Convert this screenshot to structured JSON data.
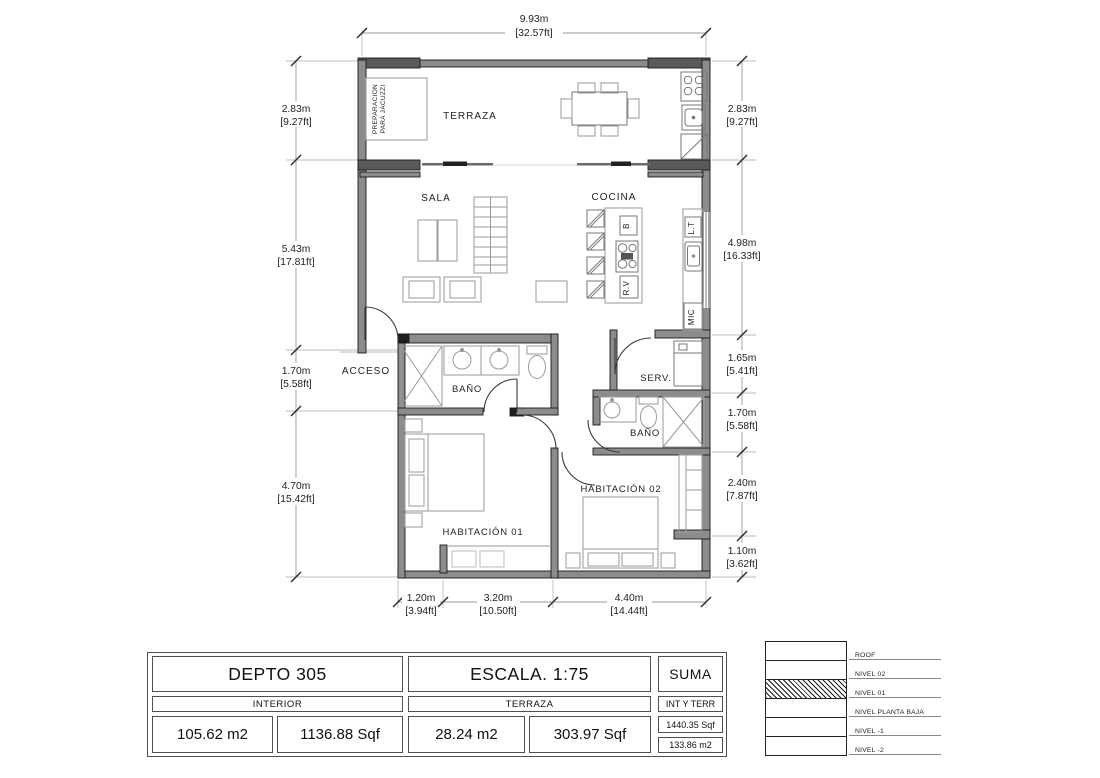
{
  "plan": {
    "rooms": {
      "terraza": "TERRAZA",
      "sala": "SALA",
      "cocina": "COCINA",
      "acceso": "ACCESO",
      "banio1": "BAÑO",
      "serv": "SERV.",
      "banio2": "BAÑO",
      "habitacion01": "HABITACIÓN 01",
      "habitacion02": "HABITACIÓN 02"
    },
    "notes": {
      "jacuzzi_line1": "PREPARACION",
      "jacuzzi_line2": "PARA JACUZZI"
    },
    "fixtures": {
      "b": "B",
      "rv": "R.V",
      "lt": "L.T",
      "mic": "MIC"
    },
    "dimensions": {
      "top": {
        "m": "9.93m",
        "ft": "[32.57ft]"
      },
      "left": [
        {
          "m": "2.83m",
          "ft": "[9.27ft]"
        },
        {
          "m": "5.43m",
          "ft": "[17.81ft]"
        },
        {
          "m": "1.70m",
          "ft": "[5.58ft]"
        },
        {
          "m": "4.70m",
          "ft": "[15.42ft]"
        }
      ],
      "right": [
        {
          "m": "2.83m",
          "ft": "[9.27ft]"
        },
        {
          "m": "4.98m",
          "ft": "[16.33ft]"
        },
        {
          "m": "1.65m",
          "ft": "[5.41ft]"
        },
        {
          "m": "1.70m",
          "ft": "[5.58ft]"
        },
        {
          "m": "2.40m",
          "ft": "[7.87ft]"
        },
        {
          "m": "1.10m",
          "ft": "[3.62ft]"
        }
      ],
      "bottom": [
        {
          "m": "1.20m",
          "ft": "[3.94ft]"
        },
        {
          "m": "3.20m",
          "ft": "[10.50ft]"
        },
        {
          "m": "4.40m",
          "ft": "[14.44ft]"
        }
      ]
    }
  },
  "title_block": {
    "unit": {
      "header": "DEPTO 305",
      "sub": "INTERIOR",
      "value_m2": "105.62 m2",
      "value_sqf": "1136.88 Sqf"
    },
    "scale": {
      "header": "ESCALA. 1:75",
      "sub": "TERRAZA",
      "value_m2": "28.24 m2",
      "value_sqf": "303.97 Sqf"
    },
    "suma": {
      "header": "SUMA",
      "sub": "INT Y TERR",
      "value_sqf": "1440.35 Sqf",
      "value_m2": "133.86 m2"
    }
  },
  "levels": {
    "items": [
      {
        "label": "ROOF"
      },
      {
        "label": "NIVEL 02"
      },
      {
        "label": "NIVEL 01"
      },
      {
        "label": "NIVEL PLANTA BAJA"
      },
      {
        "label": "NIVEL -1"
      },
      {
        "label": "NIVEL -2"
      }
    ],
    "highlighted": "NIVEL 01"
  },
  "colors": {
    "wall_fill": "#8c8c8c",
    "wall_dark": "#1e1e1e",
    "furniture_line": "#9a9a9a",
    "dim_line": "#b5b5b5",
    "text": "#222222"
  }
}
